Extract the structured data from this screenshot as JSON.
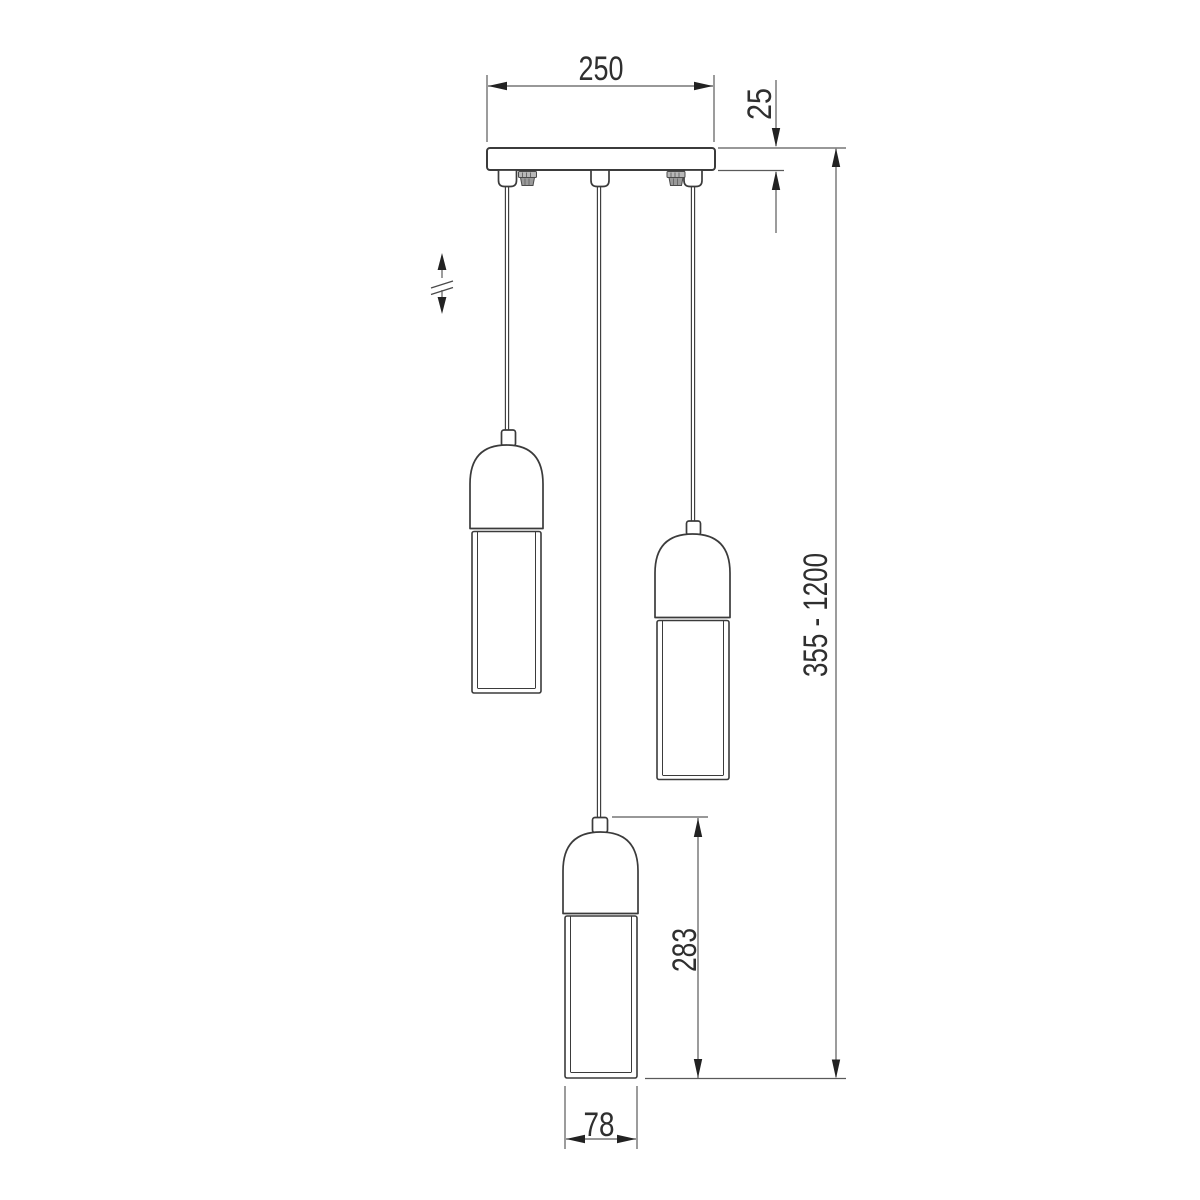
{
  "drawing": {
    "kind": "technical-dimension-drawing",
    "background": "#ffffff"
  },
  "dimensions": {
    "canopy_width": "250",
    "canopy_thickness": "25",
    "overall_height_range": "355 - 1200",
    "shade_height": "283",
    "shade_diameter": "78"
  },
  "colors": {
    "outline": "#3b3b3b",
    "dimension_line": "#5a5a5a",
    "arrow": "#222222",
    "text": "#2f2f2f"
  }
}
